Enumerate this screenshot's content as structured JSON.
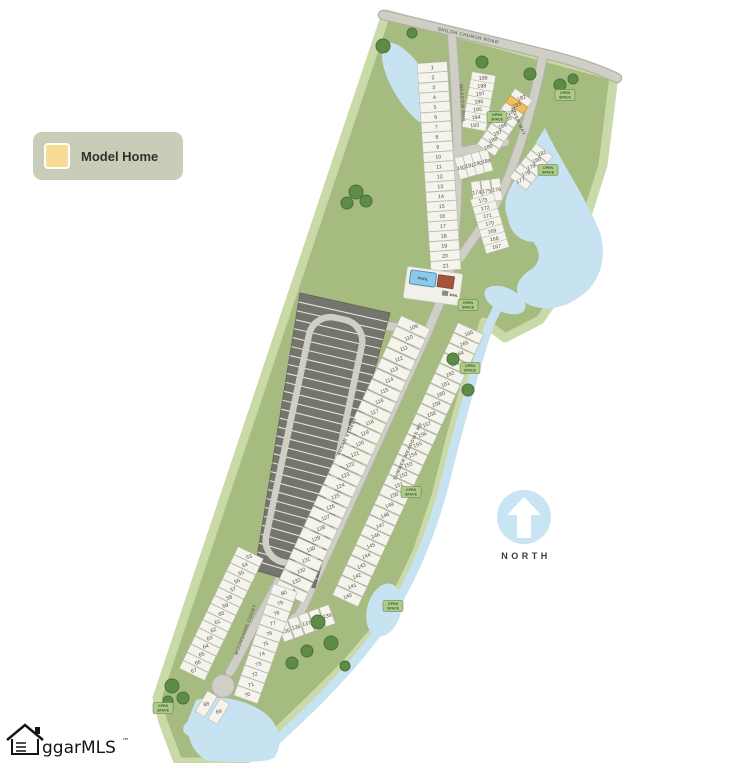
{
  "legend": {
    "model_home_label": "Model Home"
  },
  "compass": {
    "label": "NORTH"
  },
  "watermark": {
    "brand": "ggarMLS",
    "tm": "™"
  },
  "map": {
    "road_labels": {
      "shiloh": "SHILOH CHURCH ROAD",
      "meadow_run": "MEADOW RUN",
      "river_way": "RIVER WAY",
      "summer_meadows": "SUMMER MEADOWS RD",
      "susan": "SUSAN STREET",
      "moonshine": "MOONSHINE COURT"
    },
    "amenity_labels": {
      "pool": "POOL",
      "mail": "MAIL"
    },
    "open_space_label": "OPEN SPACE",
    "model_home_lot": "183",
    "lots": {
      "entry_west": [
        "1",
        "2",
        "3",
        "4",
        "5",
        "6",
        "7",
        "8",
        "9",
        "10",
        "11",
        "12",
        "13",
        "14",
        "15",
        "16",
        "17",
        "18",
        "19",
        "20",
        "21"
      ],
      "col_199_193": [
        "199",
        "198",
        "197",
        "196",
        "195",
        "194",
        "193"
      ],
      "row_192_189": [
        "192",
        "191",
        "190",
        "189"
      ],
      "row_174_176": [
        "174",
        "175",
        "176"
      ],
      "col_173_167": [
        "173",
        "172",
        "171",
        "170",
        "169",
        "168",
        "167"
      ],
      "col_182_189": [
        "182",
        "183",
        "184",
        "185",
        "186",
        "187",
        "188",
        "189"
      ],
      "col_181_177": [
        "181",
        "180",
        "179",
        "178",
        "177"
      ],
      "spine_west": [
        "109",
        "110",
        "111",
        "112",
        "113",
        "114",
        "115",
        "116",
        "117",
        "118",
        "119",
        "120",
        "121",
        "122",
        "123",
        "124",
        "125",
        "126",
        "127",
        "128",
        "129",
        "130",
        "131",
        "132",
        "133",
        "134"
      ],
      "spine_east": [
        "166",
        "165",
        "164",
        "163",
        "162",
        "161",
        "160",
        "159",
        "158",
        "157",
        "156",
        "155",
        "154",
        "153",
        "152",
        "151",
        "150",
        "149",
        "148",
        "147",
        "146",
        "145",
        "144",
        "143",
        "142",
        "141",
        "140"
      ],
      "loop_end": [
        "135",
        "136",
        "137",
        "138",
        "139"
      ],
      "bottom_west": [
        "53",
        "54",
        "55",
        "56",
        "57",
        "58",
        "59",
        "60",
        "61",
        "62",
        "63",
        "64",
        "65",
        "66",
        "67"
      ],
      "bottom_tip": [
        "68",
        "69"
      ],
      "bottom_east": [
        "80",
        "79",
        "78",
        "77",
        "76",
        "75",
        "74",
        "73",
        "72",
        "71",
        "70"
      ]
    }
  },
  "colors": {
    "land": "#a5bb80",
    "land_edge": "#c9d9a7",
    "water": "#c7e3f1",
    "road": "#cfcfc6",
    "lot_fill": "#f4f3ec",
    "dark_block": "#75756d",
    "model_home": "#f2be62",
    "tree": "#5e8c46",
    "legend_bg": "#c9cdb8",
    "legend_swatch": "#f8dc95",
    "north_blue": "#c9e5f4"
  }
}
